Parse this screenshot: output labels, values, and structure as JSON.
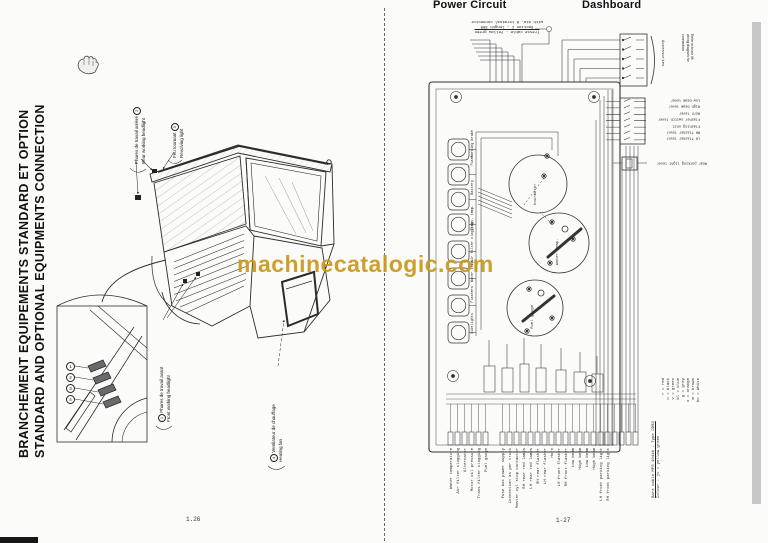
{
  "watermark": {
    "text": "machinecatalogic.com",
    "color": "#c9991c"
  },
  "left_page": {
    "title_line1": "BRANCHEMENT EQUIPEMENTS STANDARD ET OPTION",
    "title_line2": "STANDARD AND OPTIONAL EQUIPMENTS CONNECTION",
    "page_number": "1.26",
    "callouts": [
      {
        "num": "2",
        "fr": "Phares de travail arrière",
        "en": "Rear working headlight"
      },
      {
        "num": "3",
        "fr": "Feu tournant",
        "en": "Revolving light"
      },
      {
        "num": "1",
        "fr": "Phares de travail avant",
        "en": "Front working headlight"
      },
      {
        "num": "4",
        "fr": "Ventilateur de chauffage",
        "en": "Heating fan"
      }
    ],
    "inset_numbers": [
      "1",
      "2",
      "3",
      "4"
    ]
  },
  "right_page": {
    "header_power": "Power Circuit",
    "header_dashboard": "Dashboard",
    "page_number": "1-27",
    "top_note_lines": [
      "with dia. 8 terminal connector",
      "Section C - length 300",
      "Tresse cable - Yellow green"
    ],
    "accessories_label": "Accessories",
    "accessories_note_lines": [
      "Refer to truck lift",
      "wiring diagram for",
      "connection"
    ],
    "lever_labels": [
      "Low beam lever",
      "High beam lever",
      "Horn lever",
      "Flasher switch lever",
      "Flashing unit",
      "RH flasher lever",
      "LH flasher lever"
    ],
    "rear_parking_label": "Rear parking light lever",
    "gauge_labels": [
      "hourmeter",
      "water temp.",
      "fuel gauge"
    ],
    "lamp_labels": [
      "Parking brake",
      "Fuses",
      "Battery",
      "Trans. temp.",
      "Air filter clogging",
      "Water temp.",
      "Flashers",
      "Sidelights"
    ],
    "bottom_labels_group1": [
      "Water temperature",
      "Air filter clogging",
      "Alternator",
      "Motor oil pressure",
      "Trans filter clogging",
      "Fuel gauge"
    ],
    "bottom_labels_group2": [
      "Fuse box power supply",
      "Connection as per truck",
      "Master cyl stop contactor",
      "RH rear red lamps",
      "LH rear red lamps",
      "RH rear flasher",
      "LH rear flasher",
      "Horn"
    ],
    "bottom_labels_group3": [
      "LH front flasher",
      "RH front flasher",
      "Low beam",
      "High beam",
      "Low beam",
      "High beam",
      "LH front parking light",
      "RH front parking light"
    ],
    "legend_title": "Bare cable MFR 10416 - Type DDR3",
    "legend_colour_line": "Colour : jv = yellow green",
    "legend_entries": [
      "r = red",
      "n = black",
      "v = green",
      "bl = blue",
      "g = grey",
      "o = orange",
      "m = brown",
      "bc = white"
    ]
  }
}
